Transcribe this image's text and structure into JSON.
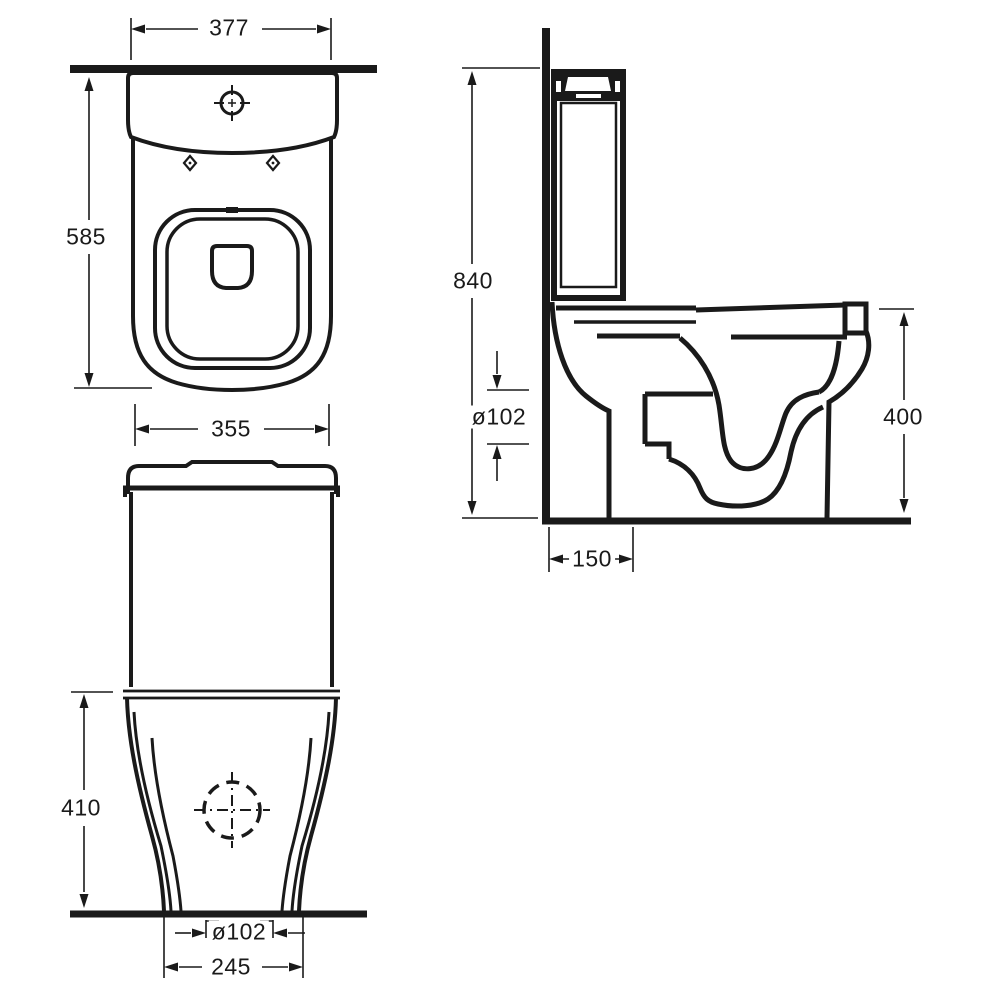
{
  "drawing": {
    "type": "technical-dimension-drawing",
    "subject": "close-coupled toilet, three orthographic views",
    "background_color": "#ffffff",
    "line_color": "#1a1a1a"
  },
  "dimensions": {
    "top_width": "377",
    "top_depth": "585",
    "cistern_width": "355",
    "front_base_height": "410",
    "front_outlet_diameter": "ø102",
    "front_base_width": "245",
    "side_overall_height": "840",
    "side_outlet_diameter": "ø102",
    "side_bowl_height": "400",
    "side_outlet_setout": "150"
  },
  "symbols": {
    "flush_button": "crosshair-target",
    "fixing_holes": "diamond-markers",
    "drain_outlet": "dashed-circle-crosshair"
  }
}
